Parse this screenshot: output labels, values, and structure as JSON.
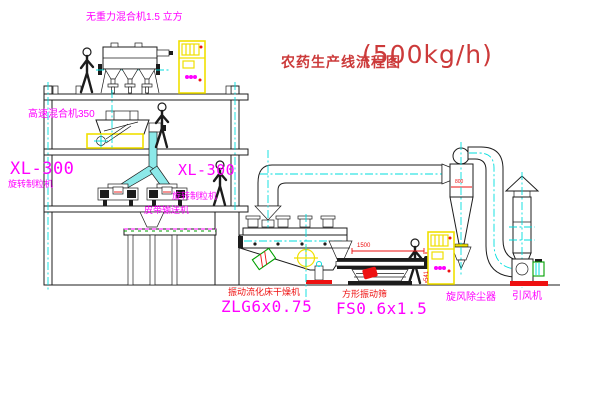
{
  "colors": {
    "line": "#1c1c1c",
    "magenta": "#ff00ff",
    "red": "#ee1111",
    "title-red": "#cc3a3a",
    "yellow": "#f0e000",
    "cyan": "#00dddd",
    "green": "#00a000",
    "chute-fill": "#8ce9e9"
  },
  "title": {
    "text": "农药生产线流程图",
    "capacity": "(500kg/h)"
  },
  "equipment_labels": {
    "gravity_mixer": "无重力混合机1.5 立方",
    "high_speed_mixer": "高速混合机350",
    "granulator_left": {
      "model": "XL-300",
      "name": "旋转制粒机"
    },
    "granulator_right": {
      "model": "XL-300",
      "name": "旋转制粒机"
    },
    "belt_conveyor": "皮带输送机",
    "fluid_bed_dryer": {
      "name": "振动流化床干燥机",
      "model": "ZLG6x0.75"
    },
    "vibrating_sieve": {
      "name": "方形振动筛",
      "model": "FS0.6x1.5"
    },
    "cyclone": "旋风除尘器",
    "induced_draft_fan": "引风机"
  },
  "dimensions": {
    "sieve_length": "1500",
    "sieve_height": "541",
    "cyclone_marking": "800"
  }
}
